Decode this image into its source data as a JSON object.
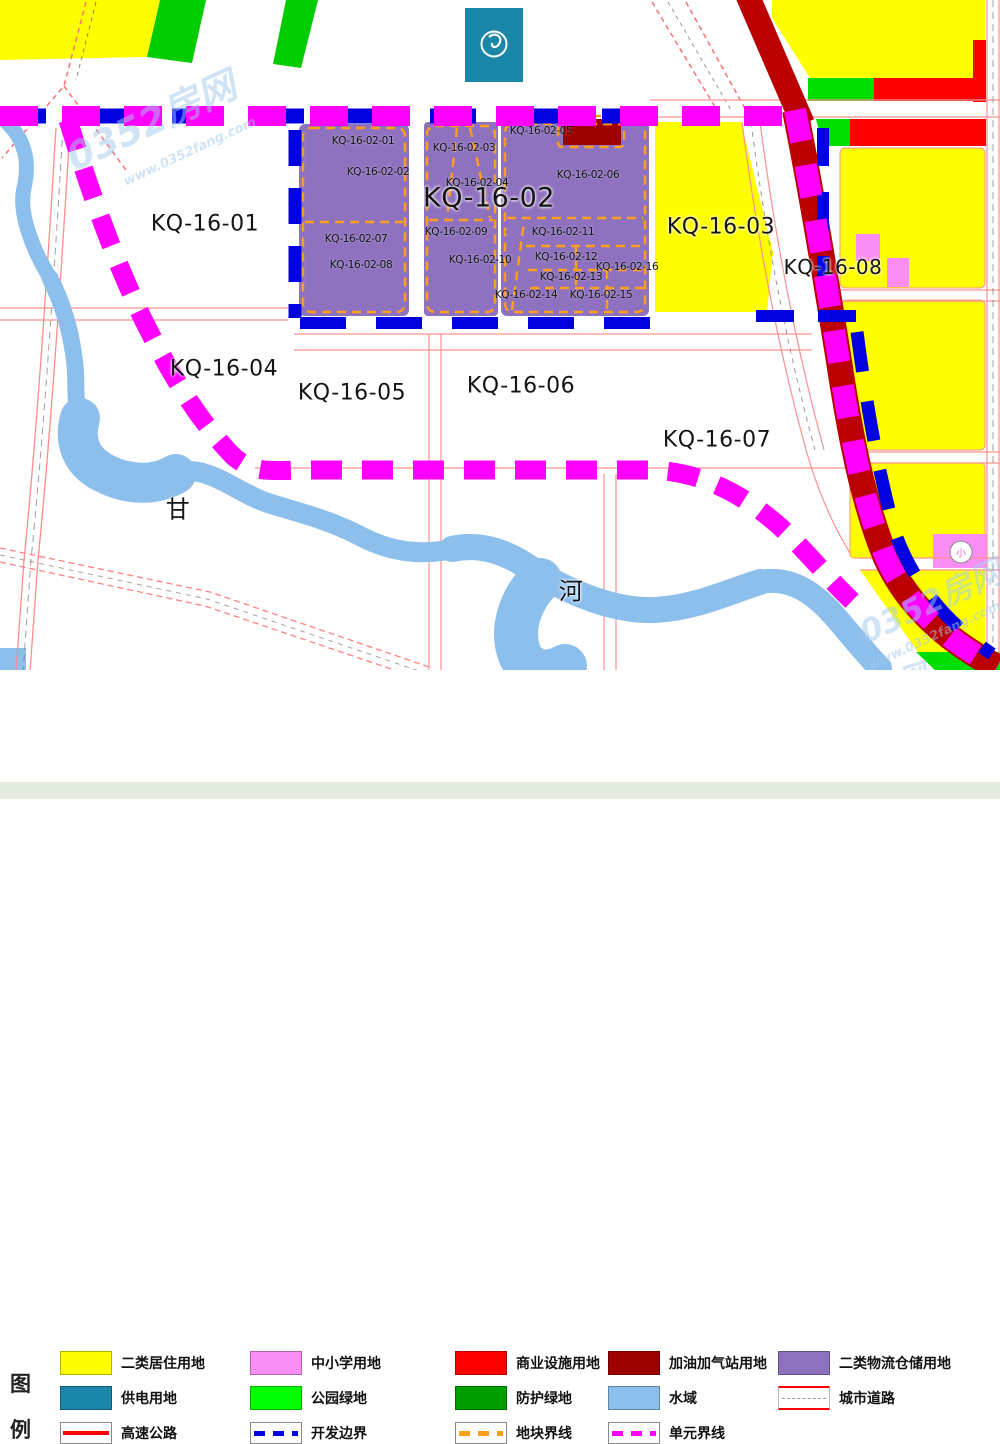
{
  "map": {
    "zones": [
      {
        "id": "zone-label-kq-16-01",
        "label": "KQ-16-01",
        "x": 205,
        "y": 224,
        "size": 22
      },
      {
        "id": "zone-label-kq-16-02",
        "label": "KQ-16-02",
        "x": 489,
        "y": 198,
        "size": 27
      },
      {
        "id": "zone-label-kq-16-03",
        "label": "KQ-16-03",
        "x": 721,
        "y": 227,
        "size": 22
      },
      {
        "id": "zone-label-kq-16-04",
        "label": "KQ-16-04",
        "x": 224,
        "y": 369,
        "size": 22
      },
      {
        "id": "zone-label-kq-16-05",
        "label": "KQ-16-05",
        "x": 352,
        "y": 393,
        "size": 22
      },
      {
        "id": "zone-label-kq-16-06",
        "label": "KQ-16-06",
        "x": 521,
        "y": 386,
        "size": 22
      },
      {
        "id": "zone-label-kq-16-07",
        "label": "KQ-16-07",
        "x": 717,
        "y": 440,
        "size": 22
      },
      {
        "id": "zone-label-kq-16-08",
        "label": "KQ-16-08",
        "x": 833,
        "y": 267,
        "size": 20
      },
      {
        "id": "river-label-gan",
        "label": "甘",
        "x": 178,
        "y": 507,
        "size": 24
      },
      {
        "id": "river-label-he",
        "label": "河",
        "x": 571,
        "y": 589,
        "size": 24
      }
    ],
    "parcels": [
      {
        "label": "KQ-16-02-01",
        "x": 363,
        "y": 141
      },
      {
        "label": "KQ-16-02-02",
        "x": 378,
        "y": 172
      },
      {
        "label": "KQ-16-02-03",
        "x": 464,
        "y": 148
      },
      {
        "label": "KQ-16-02-04",
        "x": 477,
        "y": 183
      },
      {
        "label": "KQ-16-02-05",
        "x": 541,
        "y": 131
      },
      {
        "label": "KQ-16-02-06",
        "x": 588,
        "y": 175
      },
      {
        "label": "KQ-16-02-07",
        "x": 356,
        "y": 239
      },
      {
        "label": "KQ-16-02-08",
        "x": 361,
        "y": 265
      },
      {
        "label": "KQ-16-02-09",
        "x": 456,
        "y": 232
      },
      {
        "label": "KQ-16-02-10",
        "x": 480,
        "y": 260
      },
      {
        "label": "KQ-16-02-11",
        "x": 563,
        "y": 232
      },
      {
        "label": "KQ-16-02-12",
        "x": 566,
        "y": 257
      },
      {
        "label": "KQ-16-02-13",
        "x": 571,
        "y": 277
      },
      {
        "label": "KQ-16-02-14",
        "x": 526,
        "y": 295
      },
      {
        "label": "KQ-16-02-15",
        "x": 601,
        "y": 295
      },
      {
        "label": "KQ-16-02-16",
        "x": 627,
        "y": 267
      }
    ],
    "school_icon": {
      "glyph": "小"
    },
    "watermarks": [
      {
        "text": "0352房网",
        "x": 150,
        "y": 118,
        "size": 38,
        "rot": -25
      },
      {
        "text": "www.0352fang.com",
        "x": 190,
        "y": 152,
        "size": 13,
        "rot": -25
      },
      {
        "text": "0352房网",
        "x": 930,
        "y": 600,
        "size": 32,
        "rot": -25
      },
      {
        "text": "www.0352fang.com",
        "x": 935,
        "y": 636,
        "size": 13,
        "rot": -25
      },
      {
        "text": "0352房网",
        "x": 862,
        "y": 692,
        "size": 28,
        "rot": -18
      }
    ]
  },
  "legend": {
    "title_chars": [
      "图",
      "例"
    ],
    "items": [
      {
        "label": "二类居住用地",
        "type": "fill",
        "color": "#ffff00"
      },
      {
        "label": "中小学用地",
        "type": "fill",
        "color": "#fb8ef4"
      },
      {
        "label": "商业设施用地",
        "type": "fill",
        "color": "#ff0000"
      },
      {
        "label": "加油加气站用地",
        "type": "fill",
        "color": "#9e0000"
      },
      {
        "label": "二类物流仓储用地",
        "type": "fill",
        "color": "#8f72bf"
      },
      {
        "label": "供电用地",
        "type": "fill",
        "color": "#1a86a8"
      },
      {
        "label": "公园绿地",
        "type": "fill",
        "color": "#00ff00"
      },
      {
        "label": "防护绿地",
        "type": "fill",
        "color": "#009e00"
      },
      {
        "label": "水域",
        "type": "fill",
        "color": "#8cbfec"
      },
      {
        "label": "城市道路",
        "type": "road"
      },
      {
        "label": "高速公路",
        "type": "highway",
        "color": "#ff0000"
      },
      {
        "label": "开发边界",
        "type": "dash",
        "color": "#0000e0"
      },
      {
        "label": "地块界线",
        "type": "dash",
        "color": "#ff9e1b"
      },
      {
        "label": "单元界线",
        "type": "dash",
        "color": "#ff00ff"
      }
    ]
  },
  "colors": {
    "residential": "#ffff00",
    "school": "#fb8ef4",
    "commercial": "#ff0000",
    "gas_station": "#9e0000",
    "logistics": "#8f72bf",
    "power": "#1a86a8",
    "park_green": "#00ff00",
    "protective_green": "#009e00",
    "water": "#8cbfec",
    "highway_band": "#bb0000",
    "unit_boundary": "#ff00ff",
    "dev_boundary": "#0000e0",
    "parcel_boundary": "#ff9e1b",
    "road_line": "#ff9090"
  }
}
